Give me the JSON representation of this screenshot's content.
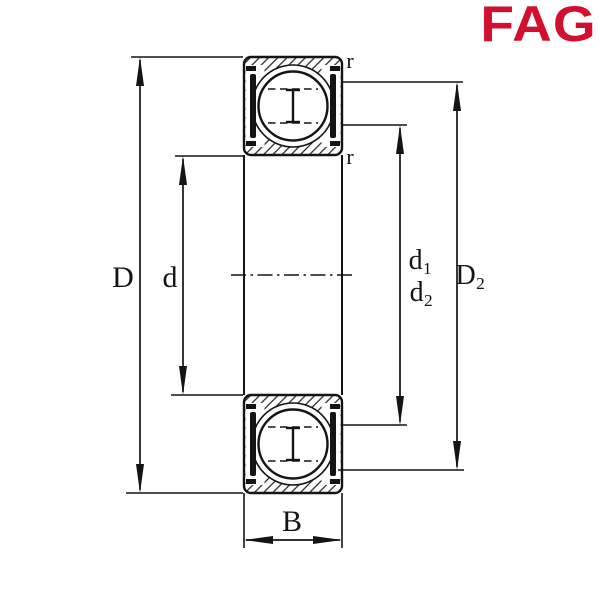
{
  "brand": {
    "logo_text": "FAG",
    "logo_color": "#D20F2F"
  },
  "drawing": {
    "subject": "deep-groove-ball-bearing-sealed-cross-section",
    "ink_color": "#141414",
    "background": "#FFFFFF",
    "labels": {
      "outer_diameter": "D",
      "bore_diameter": "d",
      "d1_base": "d",
      "d1_sub": "1",
      "d2_base": "d",
      "d2_sub": "2",
      "D2_base": "D",
      "D2_sub": "2",
      "width": "B",
      "chamfer_top": "r",
      "chamfer_bottom": "r"
    }
  }
}
